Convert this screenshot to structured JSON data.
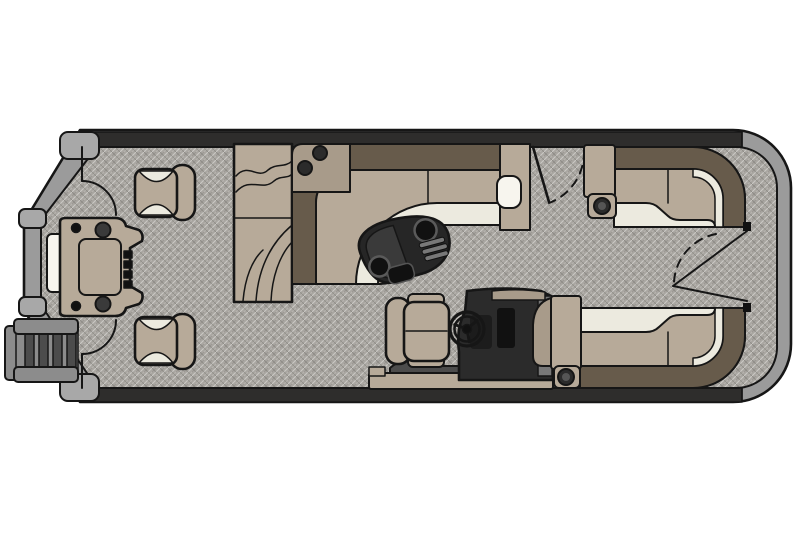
{
  "diagram": {
    "type": "pontoon-boat-floorplan",
    "view": "top-down deck layout, line-art, no text labels",
    "components": [
      "hull-rub-rail",
      "stern-corner-caps",
      "boarding-ladder",
      "transom-door",
      "stern-fishing-station",
      "stern-fishing-chair-port",
      "stern-fishing-chair-starboard",
      "stern-gate-port",
      "stern-gate-starboard",
      "chaise-lounge",
      "midship-l-lounge",
      "lounge-armrest-tray",
      "cocktail-table",
      "table-cup-holders",
      "table-speaker-grill",
      "side-boarding-gate",
      "helm-console",
      "steering-wheel",
      "captains-chair",
      "bow-lounge-port",
      "bow-lounge-starboard",
      "bow-armrest-cup-holders",
      "bow-gate",
      "bow-gate-swing-arc"
    ]
  },
  "palette": {
    "background": "#ffffff",
    "outline": "#161616",
    "hull_gray": "#9b9b9b",
    "hull_cap": "#a8a8a8",
    "rail_dark": "#2e2d2c",
    "carpet": "#a9a6a1",
    "seat_tan": "#b7aa99",
    "seat_tan_dark": "#a89b8a",
    "seat_brown": "#675b4b",
    "seat_cream": "#eceadf",
    "white_insert": "#f7f5ee",
    "table_dark": "#262626",
    "table_panel": "#3a3a3a",
    "console_dark": "#2b2b2b",
    "helm_gray": "#787878",
    "ladder_gray": "#8c8c8c",
    "ladder_dark": "#4c4c4c",
    "accent_black": "#111111"
  }
}
